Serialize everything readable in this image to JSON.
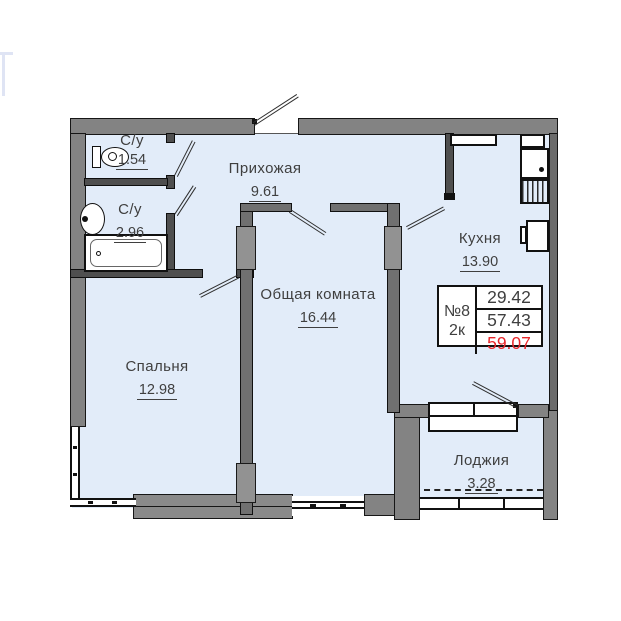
{
  "rooms": [
    {
      "name": "wc-small",
      "label": "С/у",
      "area": "1.54"
    },
    {
      "name": "wc-large",
      "label": "С/у",
      "area": "2.96"
    },
    {
      "name": "hallway",
      "label": "Прихожая",
      "area": "9.61"
    },
    {
      "name": "kitchen",
      "label": "Кухня",
      "area": "13.90"
    },
    {
      "name": "living-room",
      "label": "Общая комната",
      "area": "16.44"
    },
    {
      "name": "bedroom",
      "label": "Спальня",
      "area": "12.98"
    },
    {
      "name": "loggia",
      "label": "Лоджия",
      "area": "3.28"
    }
  ],
  "info_box": {
    "unit_number": "№8",
    "unit_type": "2к",
    "values": [
      "29.42",
      "57.43",
      "59.07"
    ],
    "highlight_color": "#e8262a"
  },
  "colors": {
    "room_fill": "#e2ecf9",
    "exterior_wall": "#838383",
    "partition_wall": "#4f4f4f",
    "accent_red": "#e8262a",
    "text": "#3f3f3f"
  },
  "icons": [
    "toilet-icon",
    "sink-icon",
    "bathtub-icon",
    "kitchen-sink-icon",
    "drying-rack-icon",
    "fridge-icon"
  ]
}
